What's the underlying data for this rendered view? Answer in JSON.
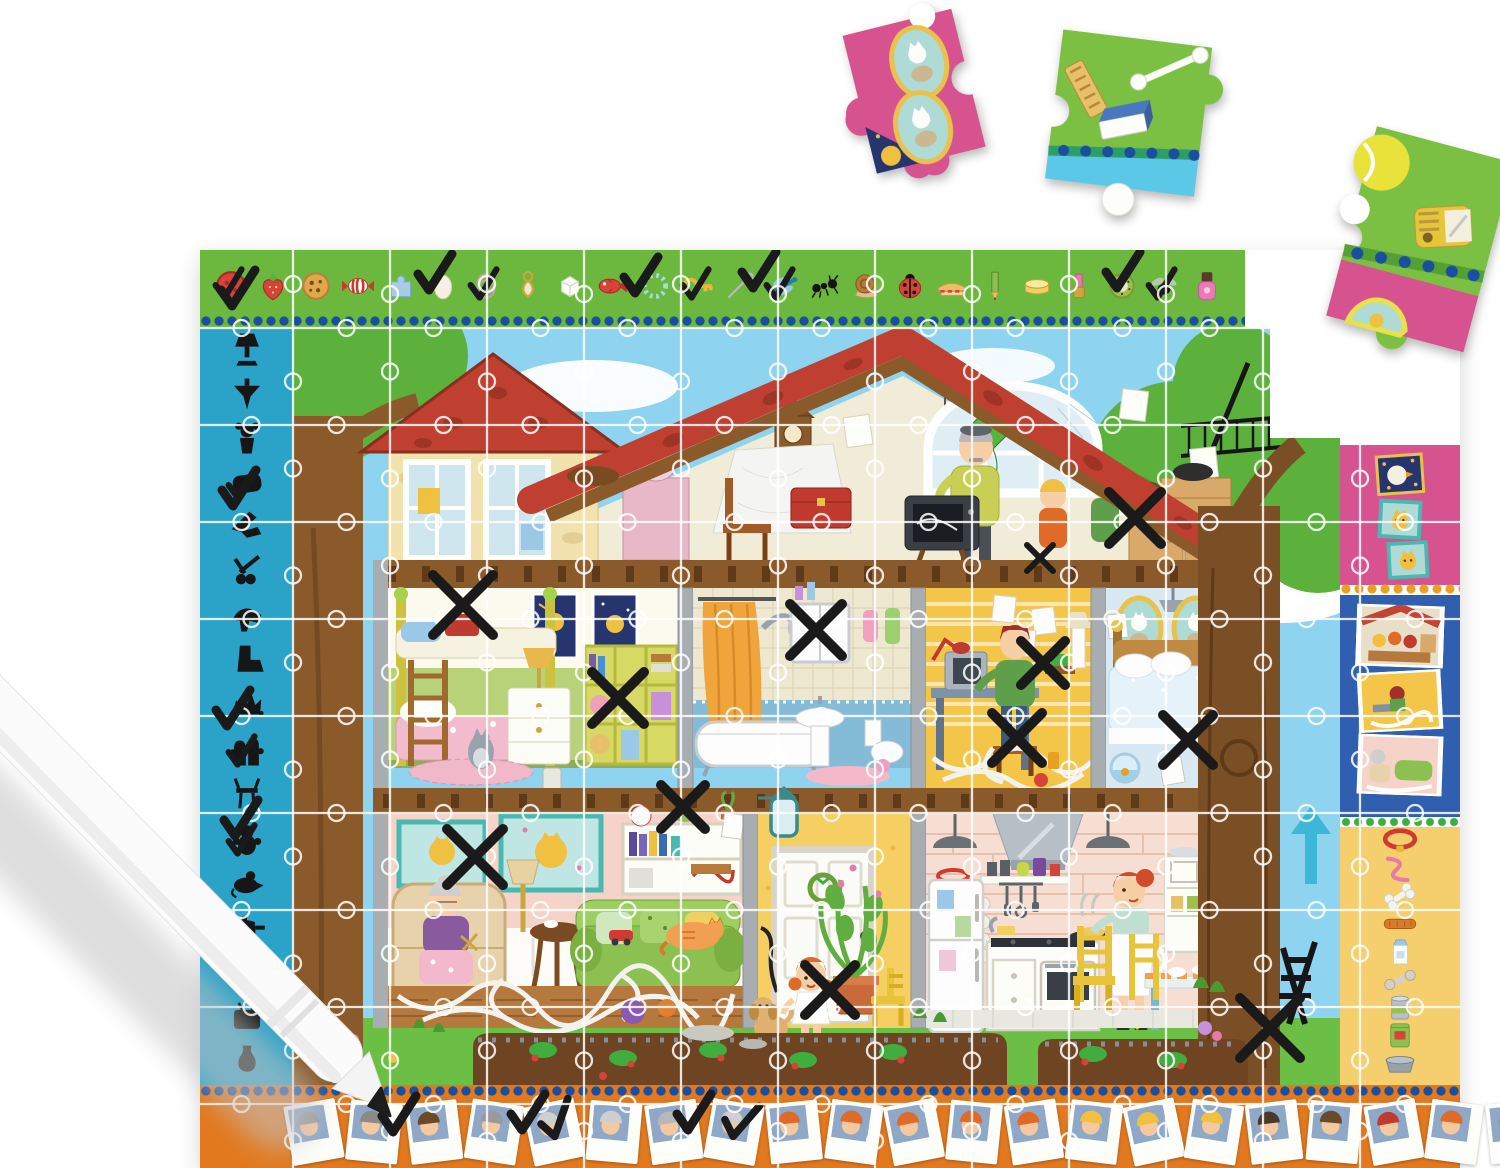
{
  "product": {
    "kind": "children's observation jigsaw puzzle with marker pen",
    "scene": "cross-section of a family house; borders show objects, silhouettes and photos to find and tick off"
  },
  "colors": {
    "border_green": "#6cb83e",
    "border_teal": "#2ba3c8",
    "border_orange": "#e2791f",
    "strip_pink": "#d6538f",
    "strip_blue": "#2f5fae",
    "strip_yellow": "#f5cf6e",
    "dot_blue": "#1a4fa0",
    "dot_gold": "#e8a020",
    "dot_green": "#3fae3f",
    "sky": "#8ed3ef",
    "grass": "#6cbf45",
    "roof": "#c0392b",
    "soil": "#6e4423",
    "mark": "#1a1a1a",
    "pen_body": "#fbfbfb"
  },
  "top_border": {
    "items": [
      {
        "id": "button",
        "checked": true
      },
      {
        "id": "strawberry"
      },
      {
        "id": "cookie"
      },
      {
        "id": "candy"
      },
      {
        "id": "puzzle"
      },
      {
        "id": "egg"
      },
      {
        "id": "rings",
        "checked": true
      },
      {
        "id": "earring"
      },
      {
        "id": "sugar"
      },
      {
        "id": "fish"
      },
      {
        "id": "bracelet"
      },
      {
        "id": "key",
        "checked": true
      },
      {
        "id": "needle"
      },
      {
        "id": "dragonfly",
        "checked": true
      },
      {
        "id": "ant"
      },
      {
        "id": "snail"
      },
      {
        "id": "ladybug"
      },
      {
        "id": "sandwich"
      },
      {
        "id": "pencil"
      },
      {
        "id": "butter"
      },
      {
        "id": "lipstick"
      },
      {
        "id": "kiwi"
      },
      {
        "id": "fly",
        "checked": true
      },
      {
        "id": "polish"
      }
    ]
  },
  "left_border": {
    "items": [
      {
        "id": "lamp"
      },
      {
        "id": "spinning-top"
      },
      {
        "id": "doll"
      },
      {
        "id": "pillow",
        "checked": true
      },
      {
        "id": "knife"
      },
      {
        "id": "scissors"
      },
      {
        "id": "high-heel"
      },
      {
        "id": "boot"
      },
      {
        "id": "hedgehog"
      },
      {
        "id": "gloves",
        "checked": true
      },
      {
        "id": "chair"
      },
      {
        "id": "teddy-bear",
        "checked": true
      },
      {
        "id": "mouse"
      },
      {
        "id": "saucepan"
      },
      {
        "id": "car"
      },
      {
        "id": "tv"
      },
      {
        "id": "vase"
      }
    ]
  },
  "right_strip": {
    "pink_pictures": [
      {
        "id": "duck"
      },
      {
        "id": "kitten"
      },
      {
        "id": "kitten"
      }
    ],
    "blue_snapshots": [
      {
        "id": "snap-attic"
      },
      {
        "id": "snap-study"
      },
      {
        "id": "snap-living"
      }
    ],
    "pet_items": [
      {
        "id": "collar"
      },
      {
        "id": "leash"
      },
      {
        "id": "bone"
      },
      {
        "id": "treat"
      },
      {
        "id": "milk"
      },
      {
        "id": "chewbone"
      },
      {
        "id": "can"
      },
      {
        "id": "bag"
      },
      {
        "id": "bowl"
      }
    ]
  },
  "bottom_border": {
    "polaroids": [
      {
        "rot": -10,
        "hair": "#9a9a9a"
      },
      {
        "rot": 6,
        "hair": "#8a8a8a"
      },
      {
        "rot": -7,
        "hair": "#6b4a2a"
      },
      {
        "rot": 9,
        "hair": "#9a9a9a"
      },
      {
        "rot": -12,
        "hair": "#cfcfcf",
        "checked": true
      },
      {
        "rot": 5,
        "hair": "#cfcfcf"
      },
      {
        "rot": -8,
        "hair": "#b8b8b8"
      },
      {
        "rot": 10,
        "hair": "#cfcfcf",
        "checked": true
      },
      {
        "rot": -6,
        "hair": "#e06a28"
      },
      {
        "rot": 8,
        "hair": "#e06a28"
      },
      {
        "rot": -11,
        "hair": "#e06a28"
      },
      {
        "rot": 6,
        "hair": "#e06a28"
      },
      {
        "rot": -9,
        "hair": "#e06a28"
      },
      {
        "rot": 7,
        "hair": "#f0c040"
      },
      {
        "rot": -12,
        "hair": "#f0c040"
      },
      {
        "rot": 9,
        "hair": "#f0c040"
      },
      {
        "rot": -7,
        "hair": "#4a3a2a"
      },
      {
        "rot": 5,
        "hair": "#6b4a2a"
      },
      {
        "rot": -10,
        "hair": "#c13a30"
      },
      {
        "rot": 8,
        "hair": "#e06a28"
      },
      {
        "rot": -6,
        "hair": "#9a9a9a"
      },
      {
        "rot": 9,
        "hair": "#e06a28"
      }
    ]
  },
  "marks": {
    "checks": [
      {
        "x": 237,
        "y": 288
      },
      {
        "x": 434,
        "y": 272
      },
      {
        "x": 640,
        "y": 275
      },
      {
        "x": 758,
        "y": 270
      },
      {
        "x": 1122,
        "y": 270
      },
      {
        "x": 238,
        "y": 488
      },
      {
        "x": 232,
        "y": 708
      },
      {
        "x": 240,
        "y": 818
      },
      {
        "x": 527,
        "y": 1112
      },
      {
        "x": 693,
        "y": 1112
      },
      {
        "x": 398,
        "y": 1114
      }
    ],
    "xmarks": [
      {
        "x": 463,
        "y": 605,
        "s": 60
      },
      {
        "x": 618,
        "y": 698,
        "s": 52
      },
      {
        "x": 816,
        "y": 630,
        "s": 52
      },
      {
        "x": 1043,
        "y": 663,
        "s": 44
      },
      {
        "x": 1017,
        "y": 738,
        "s": 50
      },
      {
        "x": 1188,
        "y": 740,
        "s": 50
      },
      {
        "x": 475,
        "y": 857,
        "s": 56
      },
      {
        "x": 683,
        "y": 807,
        "s": 44
      },
      {
        "x": 830,
        "y": 990,
        "s": 50
      },
      {
        "x": 1270,
        "y": 1028,
        "s": 60
      },
      {
        "x": 1135,
        "y": 518,
        "s": 52
      },
      {
        "x": 1040,
        "y": 558,
        "s": 26,
        "w": 6
      }
    ]
  },
  "rooms": [
    {
      "name": "attic",
      "contents": "grandfather repairing an old TV, grandchildren, boxes, cuckoo clock, broken arched window with kite"
    },
    {
      "name": "kids-bedroom",
      "contents": "bunk bed, space-cat posters, cube shelf with piggy bank"
    },
    {
      "name": "bathroom",
      "contents": "orange shower curtain, bathtub, mirror cabinet, sink"
    },
    {
      "name": "study",
      "contents": "father at computer desk with tangled cables"
    },
    {
      "name": "parents-bedroom",
      "contents": "double bed, oval cat portraits, fishbowl, small TV"
    },
    {
      "name": "living-room",
      "contents": "grandmother knitting in armchair, green sofa with sleeping cat, tangled yarn"
    },
    {
      "name": "hallway",
      "contents": "white front door with wreath, little girl with puppy"
    },
    {
      "name": "kitchen",
      "contents": "mother cooking pancakes, fridge with drawings, dining table"
    },
    {
      "name": "garden",
      "contents": "strawberry beds, folding chair, flowers"
    }
  ],
  "loose_pieces": [
    {
      "id": "piece-cat-portraits",
      "desc": "pink piece with two oval kitten portraits and starry corner"
    },
    {
      "id": "piece-school-items",
      "desc": "green piece with wafer, eraser and cotton swab"
    },
    {
      "id": "piece-sharpener",
      "desc": "green/pink corner piece with tennis ball, pencil sharpener and dotted border"
    }
  ],
  "pen": {
    "body": "white",
    "tip": "black",
    "state": "drawing a check mark on the bottom border"
  }
}
